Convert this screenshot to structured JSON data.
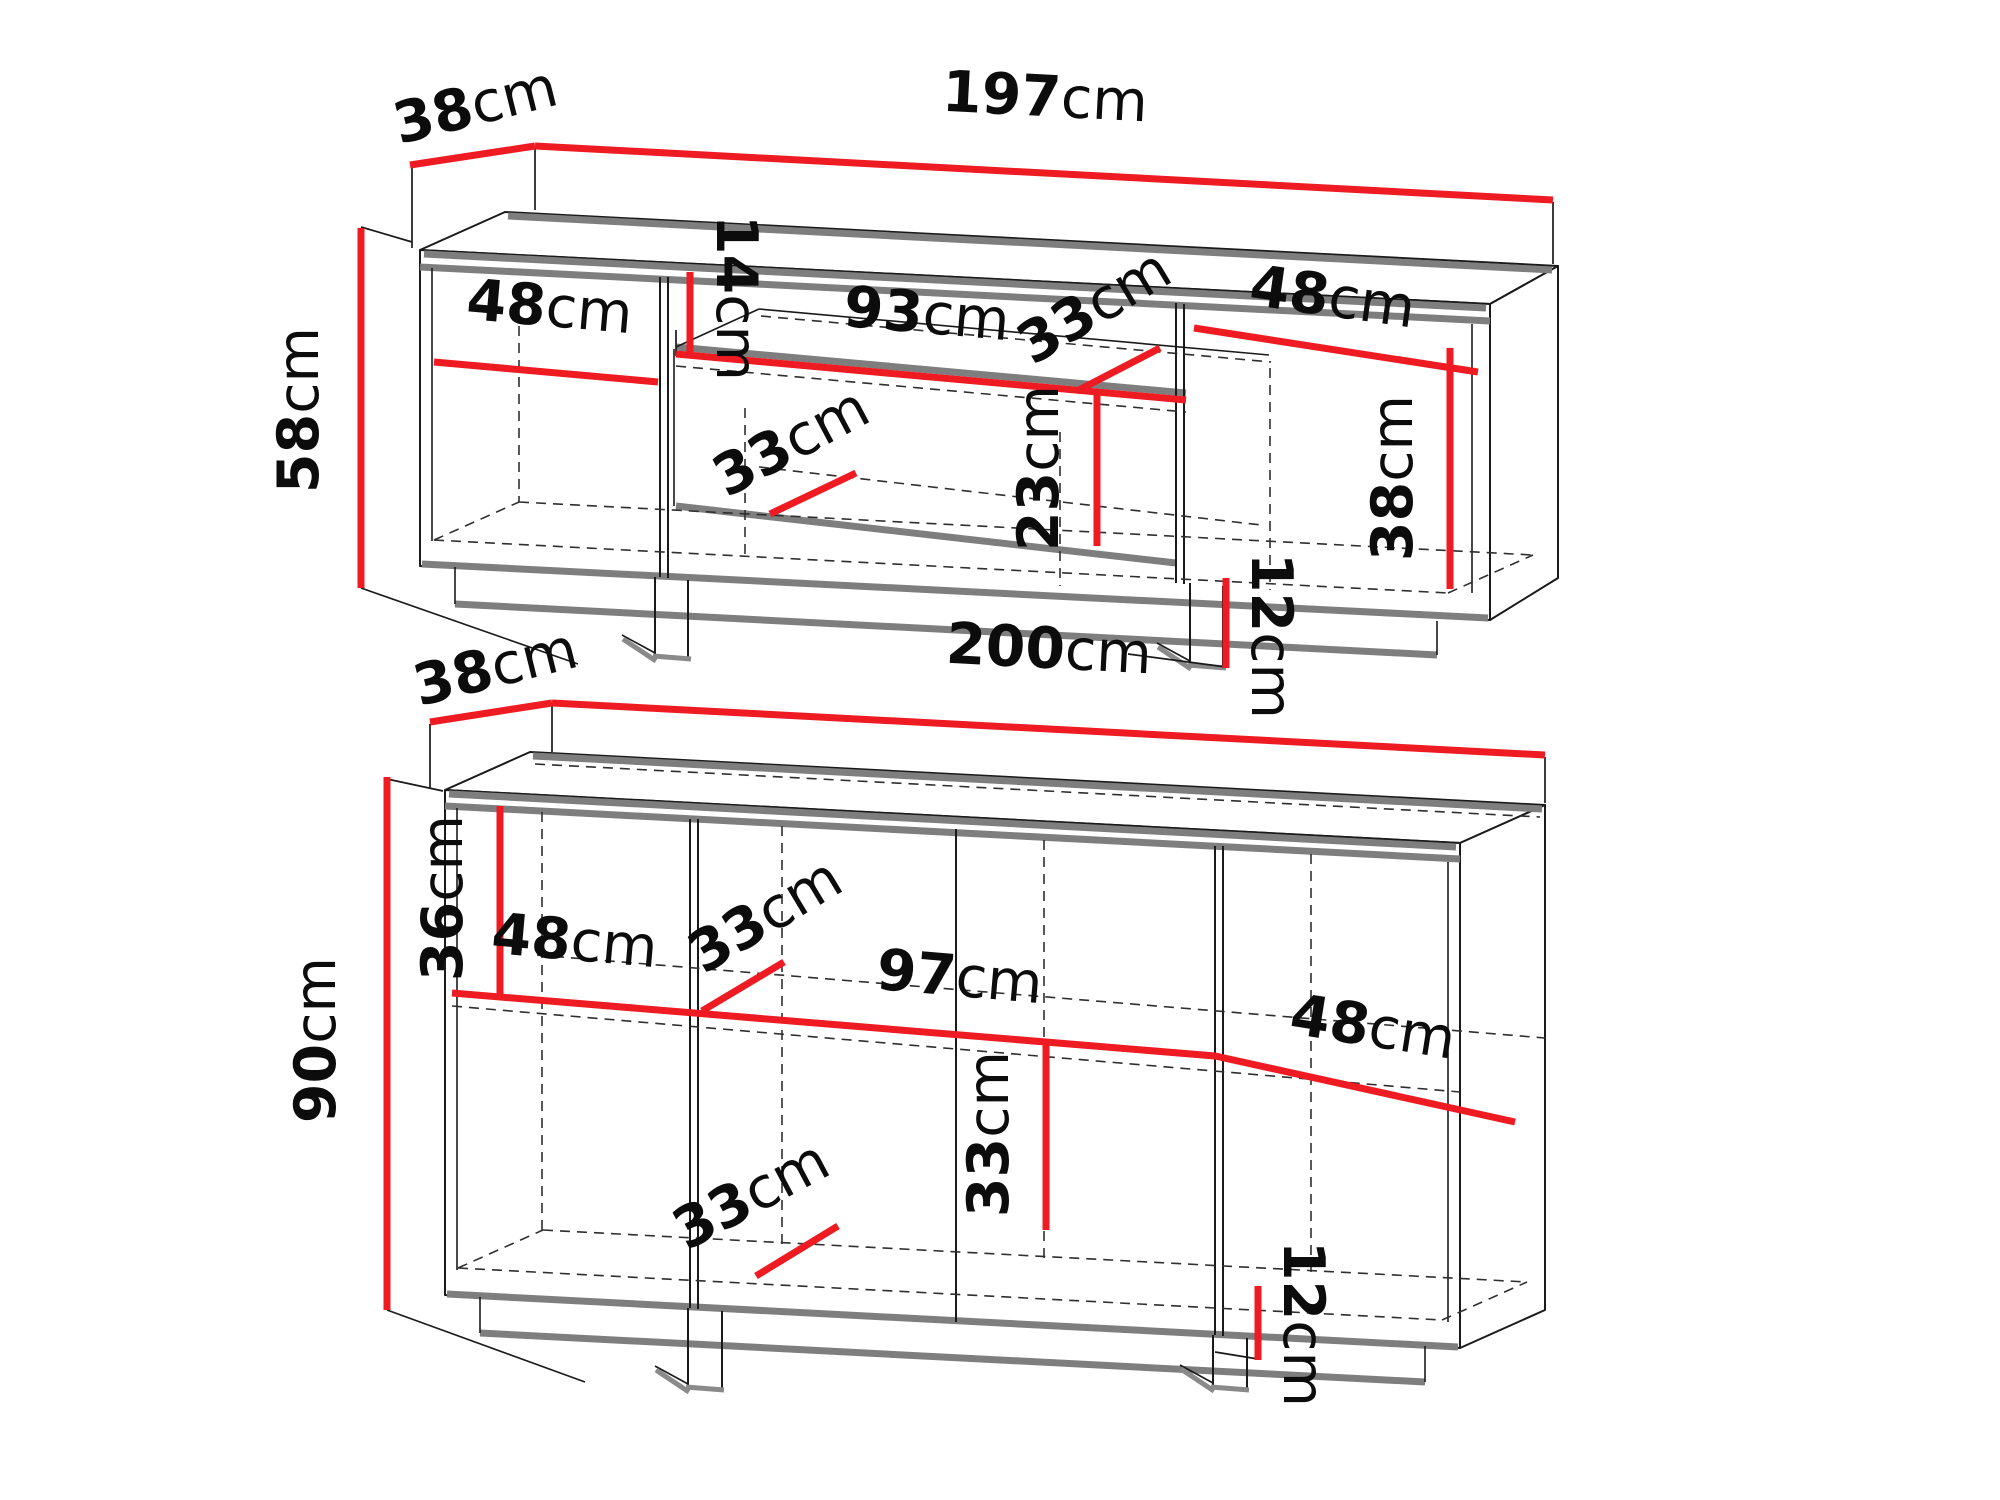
{
  "diagram": {
    "type": "furniture-dimension-drawing",
    "background": "#ffffff",
    "colors": {
      "dimension_line": "#ee1b22",
      "panel_edge_gray": "#7e7e7e",
      "outline_black": "#1a1a1a"
    },
    "units": [
      {
        "name": "tv-stand",
        "labels": {
          "width": {
            "v": "197",
            "u": "cm"
          },
          "depth": {
            "v": "38",
            "u": "cm"
          },
          "height": {
            "v": "58",
            "u": "cm"
          },
          "top_shelf_height": {
            "v": "14",
            "u": "cm"
          },
          "left_width": {
            "v": "48",
            "u": "cm"
          },
          "middle_width": {
            "v": "93",
            "u": "cm"
          },
          "shelf_depth": {
            "v": "33",
            "u": "cm"
          },
          "right_width": {
            "v": "48",
            "u": "cm"
          },
          "right_height": {
            "v": "38",
            "u": "cm"
          },
          "middle_height": {
            "v": "23",
            "u": "cm"
          },
          "bottom_depth": {
            "v": "33",
            "u": "cm"
          },
          "plinth_height": {
            "v": "12",
            "u": "cm"
          }
        }
      },
      {
        "name": "sideboard",
        "labels": {
          "width": {
            "v": "200",
            "u": "cm"
          },
          "depth": {
            "v": "38",
            "u": "cm"
          },
          "height": {
            "v": "90",
            "u": "cm"
          },
          "top_section_height": {
            "v": "36",
            "u": "cm"
          },
          "left_width": {
            "v": "48",
            "u": "cm"
          },
          "shelf_depth": {
            "v": "33",
            "u": "cm"
          },
          "middle_width": {
            "v": "97",
            "u": "cm"
          },
          "right_width": {
            "v": "48",
            "u": "cm"
          },
          "middle_height": {
            "v": "33",
            "u": "cm"
          },
          "bottom_depth": {
            "v": "33",
            "u": "cm"
          },
          "plinth_height": {
            "v": "12",
            "u": "cm"
          }
        }
      }
    ]
  }
}
